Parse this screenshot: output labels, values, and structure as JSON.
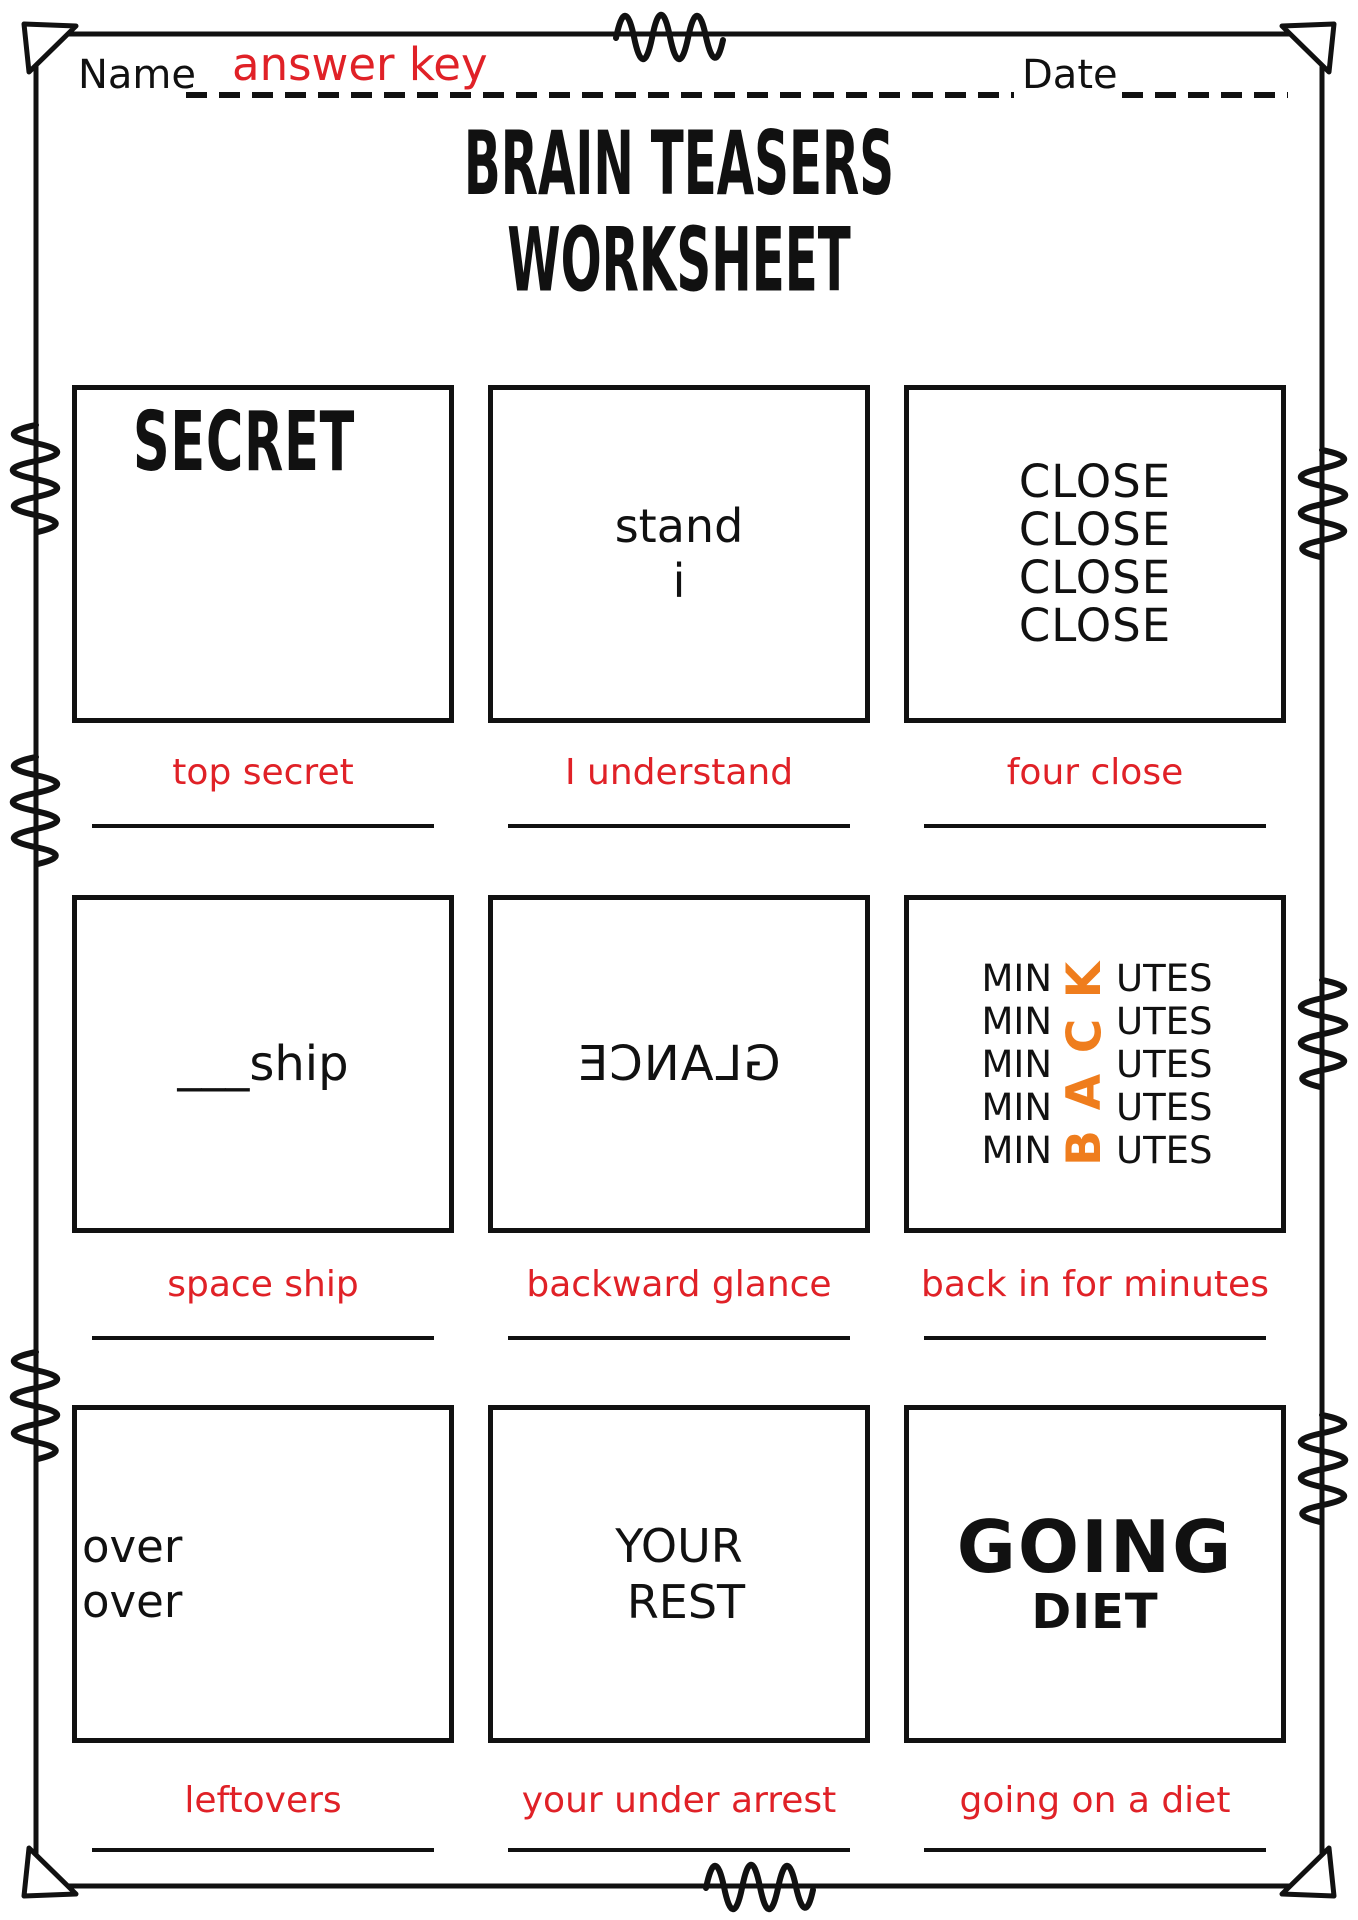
{
  "header": {
    "name_label": "Name",
    "name_value": "answer key",
    "date_label": "Date",
    "date_value": ""
  },
  "title": {
    "line1": "BRAIN TEASERS",
    "line2": "WORKSHEET"
  },
  "colors": {
    "ink": "#111111",
    "answer_red": "#e02127",
    "accent_orange": "#ef7d1d"
  },
  "puzzles": [
    {
      "id": 1,
      "text": "SECRET",
      "answer": "top secret"
    },
    {
      "id": 2,
      "line1": "stand",
      "line2": "i",
      "answer": "I understand"
    },
    {
      "id": 3,
      "word": "CLOSE",
      "repeat": 4,
      "answer": "four close"
    },
    {
      "id": 4,
      "text": "___ship",
      "answer": "space ship"
    },
    {
      "id": 5,
      "text": "GLANCE",
      "mirrored": true,
      "answer": "backward glance"
    },
    {
      "id": 6,
      "prefix": "MIN",
      "suffix": "UTES",
      "rows": 5,
      "hidden_word": "BACK",
      "hidden_letters_top_to_bottom": [
        "K",
        "C",
        "A",
        "B"
      ],
      "hidden_word_color": "#ef7d1d",
      "answer": "back in for minutes"
    },
    {
      "id": 7,
      "line1": "over",
      "line2": "over",
      "answer": "leftovers"
    },
    {
      "id": 8,
      "line1": "YOUR",
      "line2": "REST",
      "answer": "your under arrest"
    },
    {
      "id": 9,
      "line1": "GOING",
      "line2": "DIET",
      "answer": "going on a diet"
    }
  ]
}
